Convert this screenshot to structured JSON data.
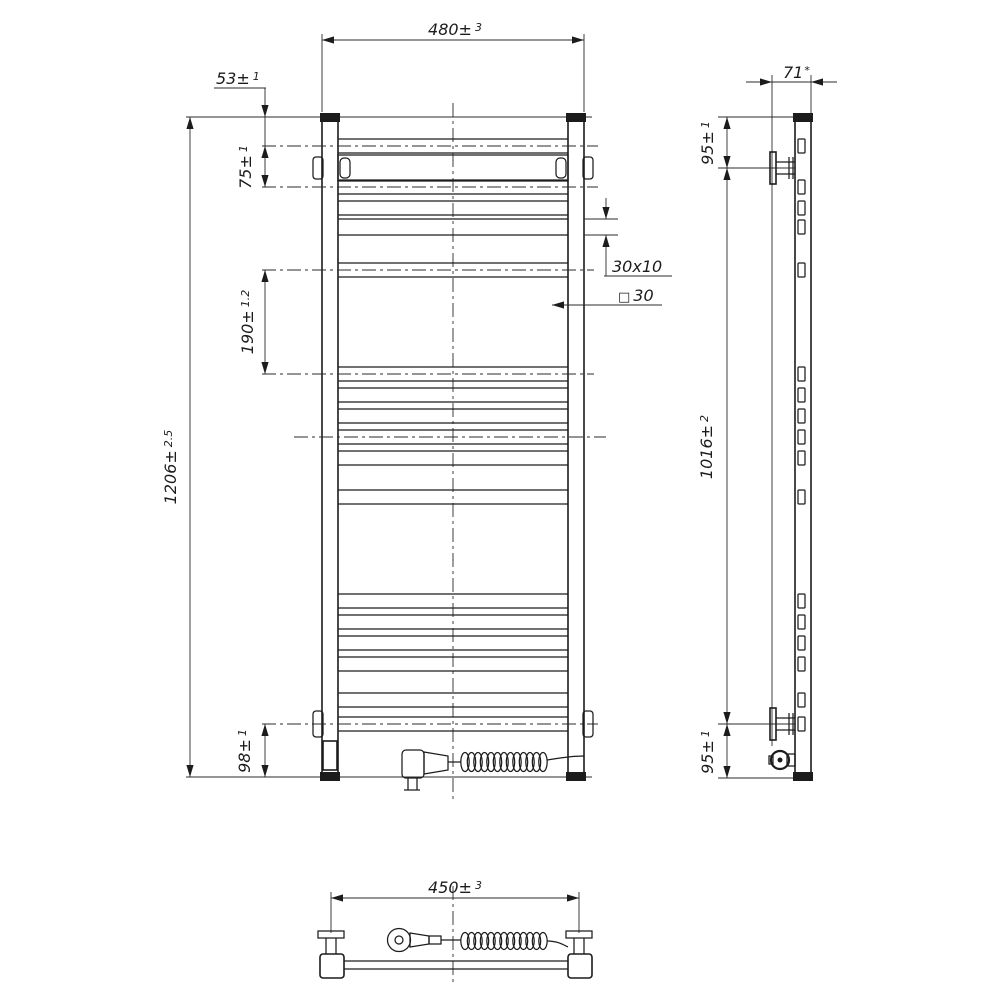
{
  "style": {
    "line_color": "#1c1c1c",
    "background": "#ffffff"
  },
  "dimensions": {
    "front_width": {
      "value": "480±",
      "tol": "3"
    },
    "top_to_first_rung": {
      "value": "53±",
      "tol": "1"
    },
    "first_rung_spacing": {
      "value": "75±",
      "tol": "1"
    },
    "rung_group_spacing": {
      "value": "190±",
      "tol": "1.2"
    },
    "overall_height": {
      "value": "1206±",
      "tol": "2.5"
    },
    "bottom_rung_offset": {
      "value": "98±",
      "tol": "1"
    },
    "rung_profile": {
      "value": "30x10"
    },
    "post_profile": {
      "symbol": "□",
      "value": "30"
    },
    "overall_depth": {
      "value": "71",
      "tol": "*"
    },
    "top_bracket_offset": {
      "value": "95±",
      "tol": "1"
    },
    "bracket_span": {
      "value": "1016±",
      "tol": "2"
    },
    "bottom_bracket_offset": {
      "value": "95±",
      "tol": "1"
    },
    "bracket_spacing_width": {
      "value": "450±",
      "tol": "3"
    }
  }
}
